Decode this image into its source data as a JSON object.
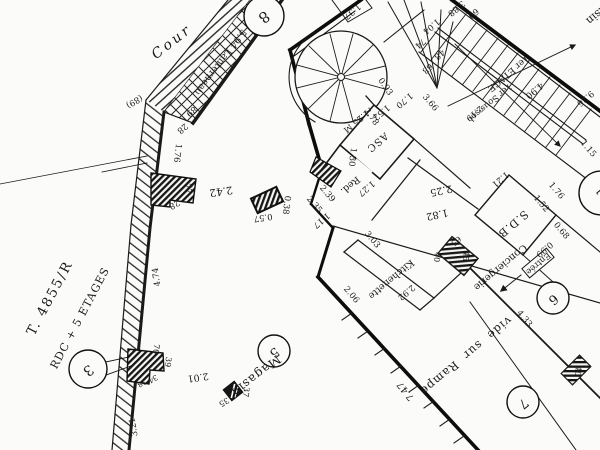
{
  "colors": {
    "ink": "#1a1a1a",
    "paper": "#fbfbf9"
  },
  "title": {
    "reference": "T. 4855/R",
    "floors": "RDC + 5 ETAGES"
  },
  "areas": {
    "cour": "Cour",
    "lanterneau": "5.94 Lanterneau",
    "magasin": "Magasin",
    "magasin_right": "Magasin",
    "vide_sur_rampe": "vide sur Rampe",
    "asc": "ASC",
    "reduit": "Red.",
    "sdb": "S.D.B",
    "entree": "Entrée",
    "conciergerie": "Conciergerie",
    "kitchenette": "Kitchenette",
    "etage_1": "1er ETAGE",
    "sous_sol": "1er Sous-sol"
  },
  "circled_numbers": {
    "n2": "2",
    "n3": "3",
    "n5": "5",
    "n6": "6",
    "n7": "7",
    "n8": "8"
  },
  "dimensions": {
    "d2_42": "2.42",
    "d0_57": "0.57",
    "d0_38": "0.38",
    "d57": "57",
    "d28": "28",
    "d1_76": "1.76",
    "d28b": "28",
    "d89": "89",
    "d89p": "(89)",
    "d4_74": "4.74",
    "d3_21": "3.21",
    "d2_01": "2.01",
    "d70": "70",
    "d39": "39",
    "d38": "38",
    "d34": "34",
    "d35": "35",
    "d37": "37",
    "d1_37": "1.37",
    "d1_04": "1.04",
    "d74": "74",
    "d48": "48",
    "d63": "63",
    "d60": "60",
    "d3_88": "3.88",
    "d3_66": "3.66",
    "d9_26": "9.26",
    "d0_93": "0.93",
    "d2_78": "2.78",
    "d1_70": "1.70",
    "d1_52": "1.52",
    "d1_25m": "1.25 M",
    "d1_30": "1.30",
    "d1_27": "1.27",
    "d1_17": "1.17",
    "d2_35": "2.35",
    "d2_39": "2.39",
    "d2_25": "2.25",
    "d1_82": "1.82",
    "d1_21": "1.21",
    "d1_76b": "1.76",
    "d1_52b": "1.52",
    "d0_68": "0.68",
    "d0_99": "0.99",
    "d4_90": "4.90",
    "d2_19": "2.19",
    "d1_15": "1.15",
    "d3_03": "3.03",
    "d2_92": "2.92",
    "d2_06": "2.06",
    "d65": "65",
    "d40": "40",
    "d45": "45",
    "d4_33": "4.33",
    "d7_47": "7.47",
    "d40b": "40"
  }
}
